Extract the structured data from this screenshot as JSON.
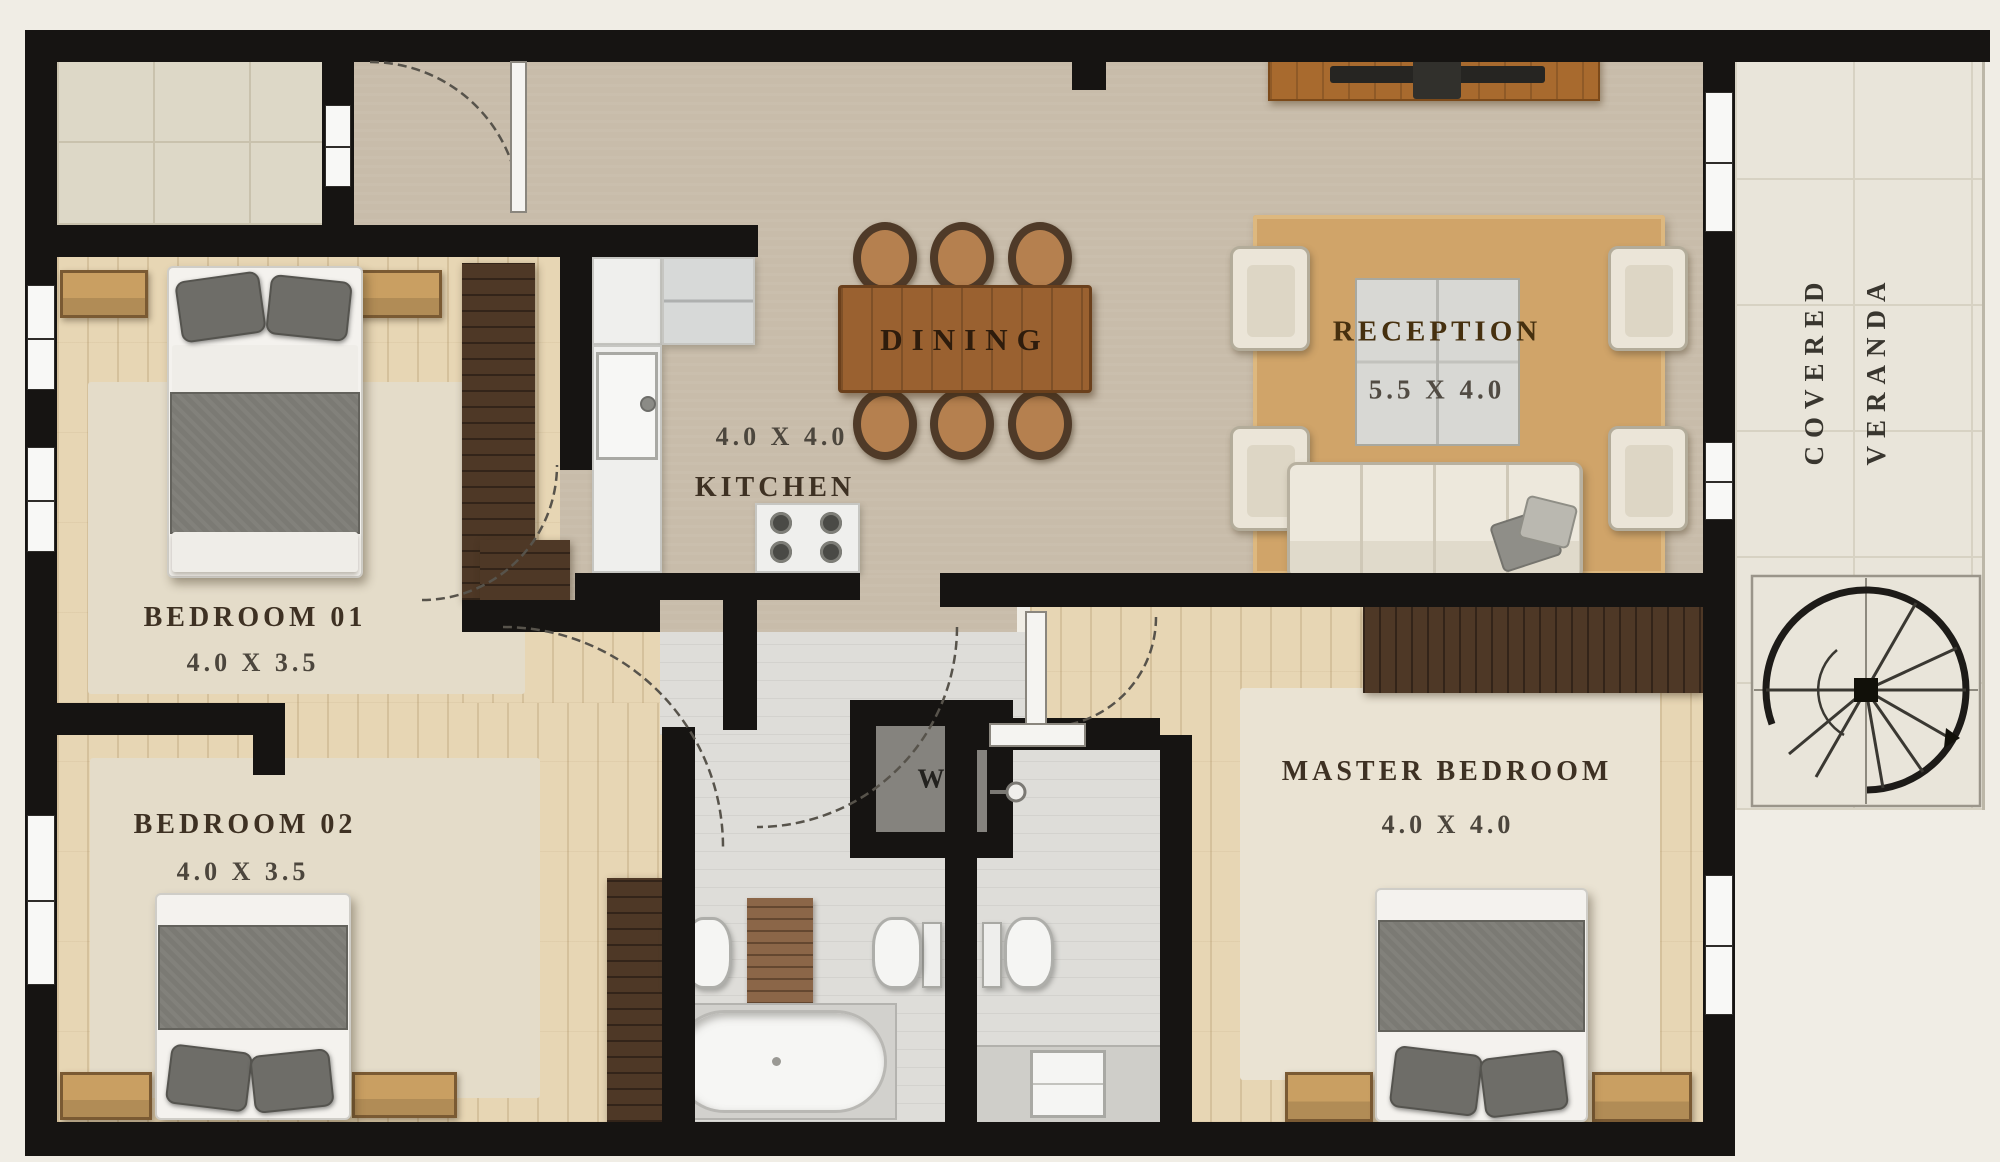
{
  "title": "apartment-floor-plan",
  "rooms": {
    "bedroom1": {
      "name": "BEDROOM 01",
      "dims": "4.0 X 3.5"
    },
    "bedroom2": {
      "name": "BEDROOM 02",
      "dims": "4.0 X 3.5"
    },
    "kitchen": {
      "name": "KITCHEN",
      "dims": "4.0 X 4.0"
    },
    "dining": {
      "name": "DINING"
    },
    "reception": {
      "name": "RECEPTION",
      "dims": "5.5 X 4.0"
    },
    "master_bedroom": {
      "name": "MASTER BEDROOM",
      "dims": "4.0 X 4.0"
    },
    "veranda": {
      "line1": "COVERED",
      "line2": "VERANDA"
    },
    "laundry_closet": {
      "label": "W"
    }
  },
  "colors": {
    "wall": "#161412",
    "background": "#f0ede5",
    "living_floor": "#c8bcaa",
    "wood_floor": "#e7d6b4",
    "bath_floor": "#deddd9",
    "reception_rug": "#d0a469",
    "wardrobe": "#4e3826",
    "dining_table": "#9a6130",
    "label_text": "#3e3123"
  }
}
